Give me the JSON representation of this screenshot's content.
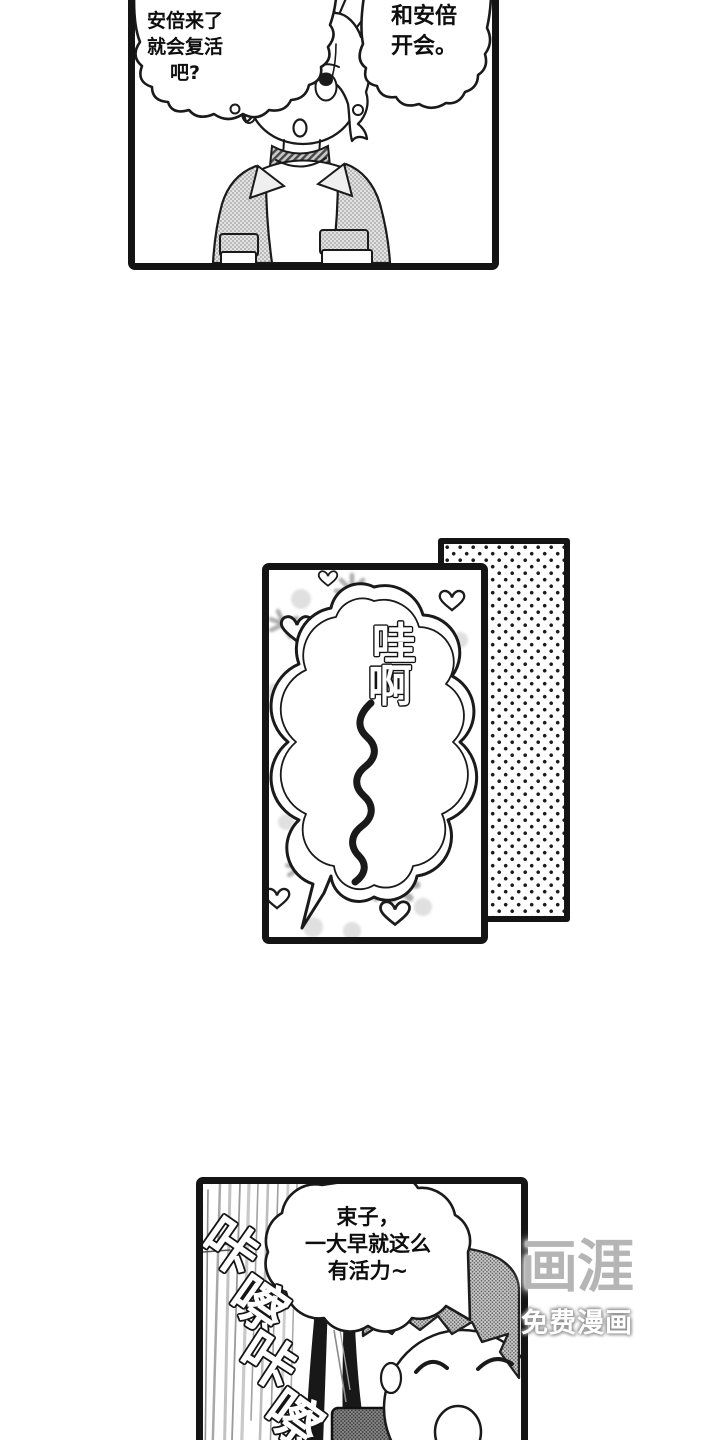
{
  "comic": {
    "panel1": {
      "thought_left": {
        "lines": [
          "安倍来了",
          "就会复活",
          "吧?"
        ]
      },
      "thought_right": {
        "lines": [
          "和安倍",
          "开会。"
        ]
      }
    },
    "panel2": {
      "exclamation": {
        "chars": [
          "哇",
          "啊"
        ]
      }
    },
    "panel4": {
      "speech": {
        "lines": [
          "束子，",
          "一大早就这么",
          "有活力~"
        ]
      },
      "sfx": {
        "chars": [
          "咔",
          "嚓",
          "咔",
          "嚓"
        ]
      }
    },
    "watermark": {
      "logo": "画涯",
      "tagline": "免费漫画"
    },
    "colors": {
      "ink": "#141414",
      "paper": "#ffffff",
      "halftone_gray": "#d9d9d9",
      "tone_dot": "#1b1b1b",
      "watermark_gray": "#b5b5b5",
      "watermark_white": "#ffffff"
    }
  }
}
